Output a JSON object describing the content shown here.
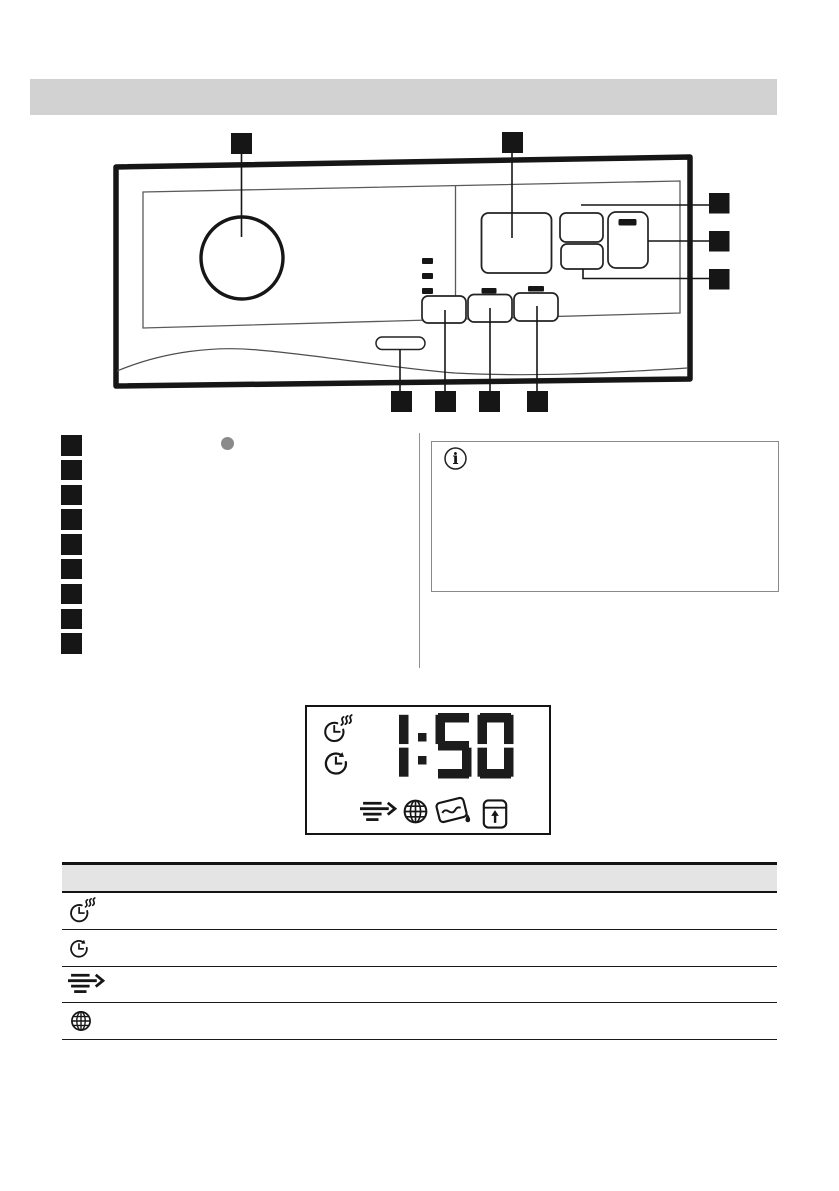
{
  "page": {
    "width": 839,
    "height": 1191,
    "background": "#ffffff"
  },
  "colors": {
    "line": "#161616",
    "heading_bar_bg": "#d2d2d2",
    "table_header_bg": "#e4e4e4",
    "bullet_gray": "#8a8a8a"
  },
  "section_heading_bar": {
    "label": ""
  },
  "control_panel_diagram": {
    "type": "line-drawing",
    "callout_markers": {
      "top_count": 2,
      "right_count": 3,
      "bottom_count": 4,
      "total": 9
    },
    "features": [
      "selector-knob",
      "display-window",
      "stacked-buttons",
      "large-button",
      "bottom-buttons",
      "pill-button",
      "indicator-dashes",
      "detergent-drawer-curve"
    ]
  },
  "legend_list": {
    "marker_count": 9,
    "items_text": [
      "",
      "",
      "",
      "",
      "",
      "",
      "",
      "",
      ""
    ]
  },
  "info_box": {
    "icon": "info-icon",
    "icon_glyph": "i",
    "text": ""
  },
  "display_panel": {
    "time": "1:50",
    "left_icons": [
      "clock-steam-icon",
      "clock-arrow-icon"
    ],
    "bottom_icons": [
      "arrows-right-icon",
      "globe-icon",
      "detergent-drop-icon",
      "door-lock-icon"
    ]
  },
  "symbols_table": {
    "header": {
      "label": ""
    },
    "rows": [
      {
        "icon": "clock-steam-icon",
        "label": ""
      },
      {
        "icon": "clock-arrow-icon",
        "label": ""
      },
      {
        "icon": "arrows-right-icon",
        "label": ""
      },
      {
        "icon": "globe-icon",
        "label": ""
      }
    ]
  }
}
